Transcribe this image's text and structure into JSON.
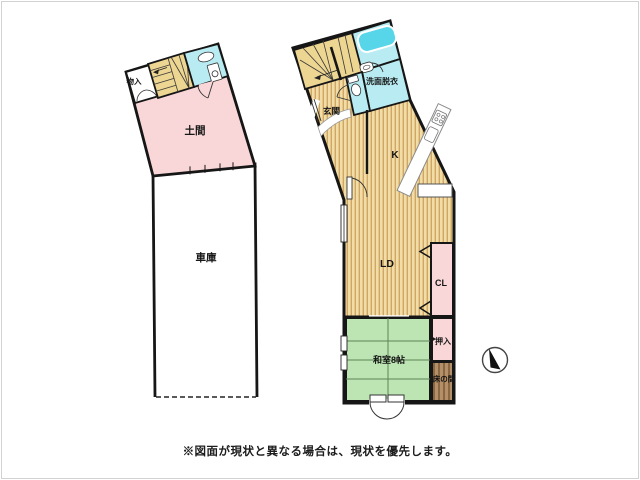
{
  "note": {
    "text": "※図面が現状と異なる場合は、現状を優先します。"
  },
  "left_building": {
    "rooms": {
      "storage": {
        "label": "物入"
      },
      "doma": {
        "label": "土間"
      },
      "garage": {
        "label": "車庫"
      }
    }
  },
  "right_building": {
    "rooms": {
      "entrance": {
        "label": "玄関"
      },
      "washroom": {
        "label": "洗面脱衣"
      },
      "kitchen": {
        "label": "K"
      },
      "living_dining": {
        "label": "LD"
      },
      "closet": {
        "label": "CL"
      },
      "japanese_room": {
        "label": "和室8帖"
      },
      "oshiire": {
        "label": "押入"
      },
      "tokonoma": {
        "label": "床の間"
      }
    }
  },
  "colors": {
    "wall": "#161616",
    "room_pink": "#f9d7d8",
    "room_cyan": "#b9ecf2",
    "bathtub_blue": "#58d6e9",
    "floor_light": "#f2dda7",
    "floor_dark": "#cfa763",
    "stairs_fill": "#edd592",
    "tatami_green": "#bde5b3",
    "tatami_line": "#5d8456",
    "tokonoma_light": "#b4906a",
    "tokonoma_dark": "#8a6741",
    "fixture_white": "#ffffff",
    "frame": "#d2d2d2"
  }
}
